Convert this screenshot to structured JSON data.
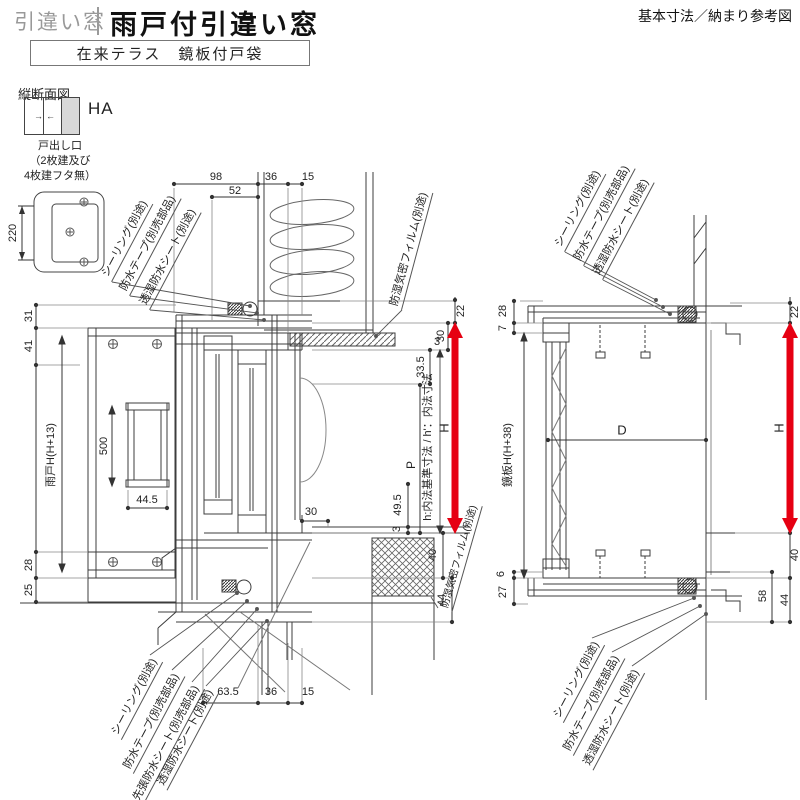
{
  "header": {
    "category": "引違い窓",
    "title": "雨戸付引違い窓",
    "subtitle": "在来テラス　鏡板付戸袋",
    "note": "基本寸法／納まり参考図",
    "section": "縦断面図"
  },
  "legend": {
    "ha": "HA",
    "outlet": [
      "戸出し口",
      "（2枚建及び",
      "4枚建フタ無）"
    ],
    "dim220": "220"
  },
  "left": {
    "top": {
      "d98": "98",
      "d52": "52",
      "d36": "36",
      "d15": "15"
    },
    "side": {
      "d31": "31",
      "d41": "41",
      "amado": "雨戸H(H+13)",
      "d500": "500",
      "d445": "44.5",
      "d28": "28",
      "d25": "25"
    },
    "right": {
      "d22": "22",
      "d30": "30",
      "d335": "33.5",
      "d3a": "3",
      "hbase": "h:内法基準寸法 / h'：内法寸法",
      "H": "H",
      "P": "P",
      "d495": "49.5",
      "d3b": "3",
      "d30b": "30",
      "d40": "40",
      "d44": "44"
    },
    "bottom": {
      "d635": "63.5",
      "d36": "36",
      "d15": "15"
    },
    "co_top": [
      "シーリング(別途)",
      "防水テープ(別売部品)",
      "透湿防水シート(別途)"
    ],
    "film_top": "防湿気密フィルム(別途)",
    "co_bottom": [
      "シーリング(別途)",
      "防水テープ(別売部品)",
      "先張防水シート(別売部品)",
      "透湿防水シート(別途)"
    ],
    "film_bottom": "防湿気密フィルム(別途)"
  },
  "right": {
    "co_top": [
      "シーリング(別途)",
      "防水テープ(別売部品)",
      "透湿防水シート(別途)"
    ],
    "co_bottom": [
      "シーリング(別途)",
      "防水テープ(別売部品)",
      "透湿防水シート(別途)"
    ],
    "side": {
      "d28": "28",
      "d7": "7",
      "kagami": "鏡板H(H+38)",
      "d6": "6",
      "d27": "27"
    },
    "D": "D",
    "rside": {
      "d22": "22",
      "H": "H",
      "d40": "40",
      "d58": "58",
      "d44": "44"
    }
  },
  "colors": {
    "accent_red": "#e60012",
    "line": "#3c3c3c",
    "shutter_gray": "#d8d8d8"
  }
}
